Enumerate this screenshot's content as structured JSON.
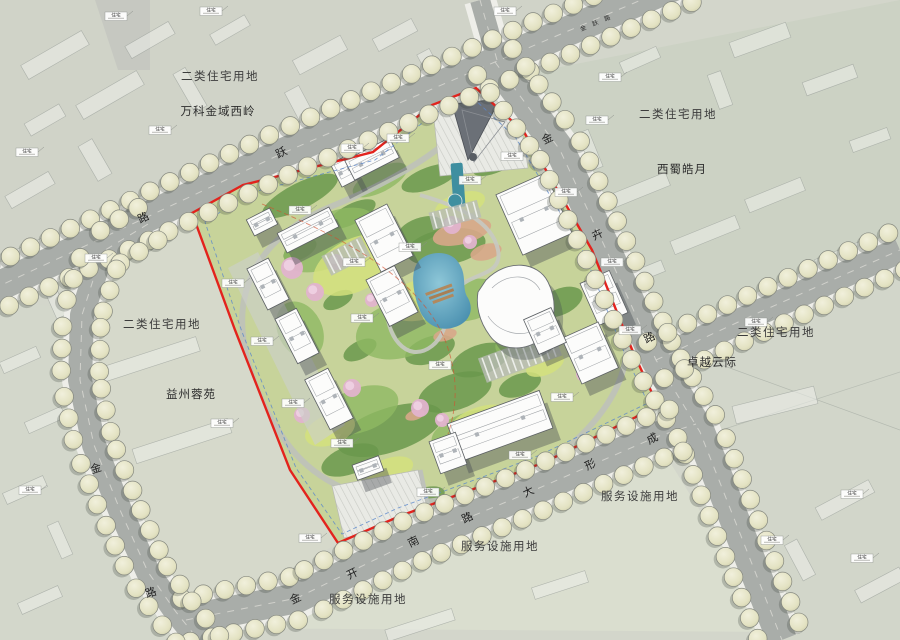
{
  "map": {
    "type": "site-master-plan",
    "land_use_labels": [
      {
        "text": "二类住宅用地",
        "x": 220,
        "y": 80
      },
      {
        "text": "二类住宅用地",
        "x": 678,
        "y": 118
      },
      {
        "text": "二类住宅用地",
        "x": 162,
        "y": 328
      },
      {
        "text": "二类住宅用地",
        "x": 776,
        "y": 336
      },
      {
        "text": "服务设施用地",
        "x": 640,
        "y": 500
      },
      {
        "text": "服务设施用地",
        "x": 500,
        "y": 550
      },
      {
        "text": "服务设施用地",
        "x": 368,
        "y": 603
      }
    ],
    "project_labels": [
      {
        "text": "万科金域西岭",
        "x": 218,
        "y": 115
      },
      {
        "text": "西蜀皓月",
        "x": 682,
        "y": 173
      },
      {
        "text": "卓越云际",
        "x": 712,
        "y": 366
      },
      {
        "text": "益州蓉苑",
        "x": 191,
        "y": 398
      }
    ],
    "road_labels": [
      {
        "name": "top-road",
        "rot": -26,
        "small": false,
        "chars": [
          {
            "t": "跃",
            "x": 283,
            "y": 156
          },
          {
            "t": "路",
            "x": 145,
            "y": 221
          }
        ]
      },
      {
        "name": "top-road-ne",
        "rot": -24,
        "small": true,
        "chars": [
          {
            "t": "金",
            "x": 584,
            "y": 30
          },
          {
            "t": "跃",
            "x": 596,
            "y": 25
          },
          {
            "t": "路",
            "x": 608,
            "y": 20
          }
        ]
      },
      {
        "name": "right-road",
        "rot": -26,
        "small": false,
        "chars": [
          {
            "t": "金",
            "x": 549,
            "y": 142
          },
          {
            "t": "卉",
            "x": 599,
            "y": 238
          },
          {
            "t": "路",
            "x": 651,
            "y": 341
          }
        ]
      },
      {
        "name": "bottom-road",
        "rot": -26,
        "small": false,
        "chars": [
          {
            "t": "金",
            "x": 297,
            "y": 602
          },
          {
            "t": "开",
            "x": 354,
            "y": 577
          },
          {
            "t": "南",
            "x": 415,
            "y": 545
          },
          {
            "t": "路",
            "x": 469,
            "y": 521
          },
          {
            "t": "大",
            "x": 530,
            "y": 495
          },
          {
            "t": "形",
            "x": 592,
            "y": 468
          },
          {
            "t": "成",
            "x": 654,
            "y": 442
          }
        ]
      },
      {
        "name": "left-road",
        "rot": -18,
        "small": false,
        "chars": [
          {
            "t": "金",
            "x": 97,
            "y": 472
          },
          {
            "t": "路",
            "x": 152,
            "y": 596
          }
        ]
      }
    ],
    "annotations": {
      "residential": "住宅"
    },
    "colors": {
      "boundary_red": "#e3231d",
      "setback_blue": "#5a87cc",
      "road_gray": "#a9ada9",
      "sidewalk": "#eeeee9",
      "site_green": "#c7d39a",
      "dark_tree_green": "#6a984c",
      "lawn_yellow": "#d3e07c",
      "water_teal": "#3e88a8",
      "pink_blossom": "#e2b3ce",
      "street_tree": "#e6e5c8",
      "salmon_planting": "#d7a78a"
    }
  }
}
